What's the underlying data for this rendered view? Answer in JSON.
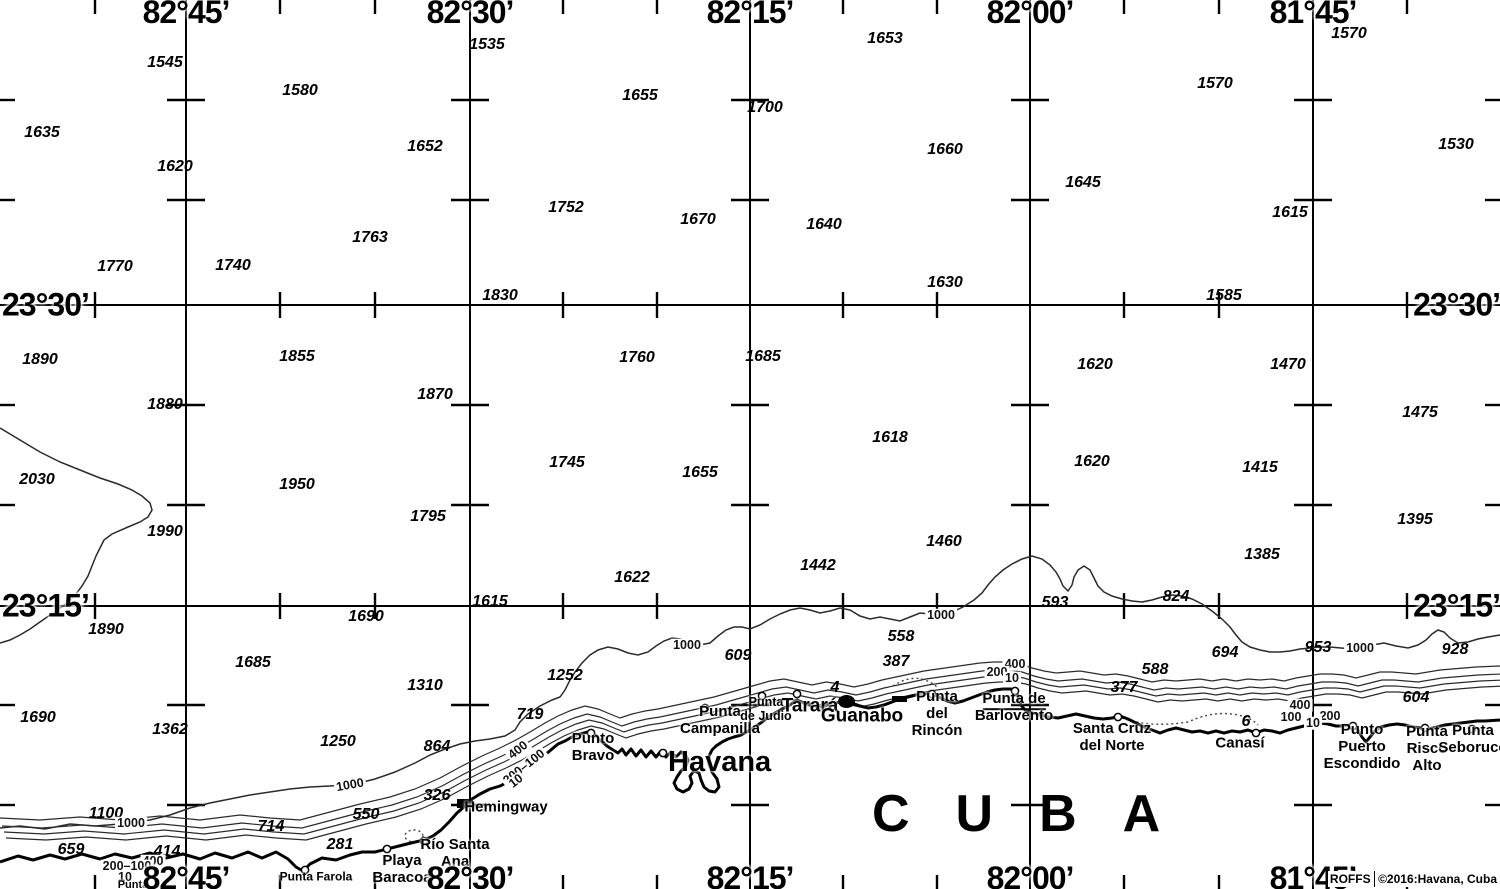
{
  "map": {
    "region_label": "CUBA",
    "city_label": "Havana",
    "credit": {
      "agency": "ROFFS",
      "copyright": "©2016:Havana, Cuba"
    },
    "grid": {
      "lon_lines": [
        {
          "label": "82°45’",
          "x": 186
        },
        {
          "label": "82°30’",
          "x": 470
        },
        {
          "label": "82°15’",
          "x": 750
        },
        {
          "label": "82°00’",
          "x": 1030
        },
        {
          "label": "81°45’",
          "x": 1313
        }
      ],
      "lat_lines": [
        {
          "label": "23°30’",
          "y": 305
        },
        {
          "label": "23°15’",
          "y": 606
        }
      ],
      "minor_tick_x": [
        95,
        280,
        375,
        563,
        657,
        843,
        937,
        1124,
        1219,
        1407
      ],
      "minor_tick_y": [
        100,
        200,
        405,
        505,
        705,
        805
      ]
    },
    "soundings": [
      {
        "v": "1545",
        "x": 165,
        "y": 63
      },
      {
        "v": "1535",
        "x": 487,
        "y": 45
      },
      {
        "v": "1653",
        "x": 885,
        "y": 39
      },
      {
        "v": "1570",
        "x": 1349,
        "y": 34
      },
      {
        "v": "1580",
        "x": 300,
        "y": 91
      },
      {
        "v": "1655",
        "x": 640,
        "y": 96
      },
      {
        "v": "1700",
        "x": 765,
        "y": 108
      },
      {
        "v": "1570",
        "x": 1215,
        "y": 84
      },
      {
        "v": "1635",
        "x": 42,
        "y": 133
      },
      {
        "v": "1652",
        "x": 425,
        "y": 147
      },
      {
        "v": "1660",
        "x": 945,
        "y": 150
      },
      {
        "v": "1530",
        "x": 1456,
        "y": 145
      },
      {
        "v": "1620",
        "x": 175,
        "y": 167
      },
      {
        "v": "1645",
        "x": 1083,
        "y": 183
      },
      {
        "v": "1752",
        "x": 566,
        "y": 208
      },
      {
        "v": "1670",
        "x": 698,
        "y": 220
      },
      {
        "v": "1640",
        "x": 824,
        "y": 225
      },
      {
        "v": "1615",
        "x": 1290,
        "y": 213
      },
      {
        "v": "1763",
        "x": 370,
        "y": 238
      },
      {
        "v": "1770",
        "x": 115,
        "y": 267
      },
      {
        "v": "1740",
        "x": 233,
        "y": 266
      },
      {
        "v": "1630",
        "x": 945,
        "y": 283
      },
      {
        "v": "1830",
        "x": 500,
        "y": 296
      },
      {
        "v": "1585",
        "x": 1224,
        "y": 296
      },
      {
        "v": "1890",
        "x": 40,
        "y": 360
      },
      {
        "v": "1855",
        "x": 297,
        "y": 357
      },
      {
        "v": "1760",
        "x": 637,
        "y": 358
      },
      {
        "v": "1685",
        "x": 763,
        "y": 357
      },
      {
        "v": "1620",
        "x": 1095,
        "y": 365
      },
      {
        "v": "1470",
        "x": 1288,
        "y": 365
      },
      {
        "v": "1880",
        "x": 165,
        "y": 405
      },
      {
        "v": "1870",
        "x": 435,
        "y": 395
      },
      {
        "v": "1475",
        "x": 1420,
        "y": 413
      },
      {
        "v": "1618",
        "x": 890,
        "y": 438
      },
      {
        "v": "2030",
        "x": 37,
        "y": 480
      },
      {
        "v": "1950",
        "x": 297,
        "y": 485
      },
      {
        "v": "1745",
        "x": 567,
        "y": 463
      },
      {
        "v": "1655",
        "x": 700,
        "y": 473
      },
      {
        "v": "1620",
        "x": 1092,
        "y": 462
      },
      {
        "v": "1415",
        "x": 1260,
        "y": 468
      },
      {
        "v": "1990",
        "x": 165,
        "y": 532
      },
      {
        "v": "1795",
        "x": 428,
        "y": 517
      },
      {
        "v": "1460",
        "x": 944,
        "y": 542
      },
      {
        "v": "1395",
        "x": 1415,
        "y": 520
      },
      {
        "v": "1442",
        "x": 818,
        "y": 566
      },
      {
        "v": "1385",
        "x": 1262,
        "y": 555
      },
      {
        "v": "1622",
        "x": 632,
        "y": 578
      },
      {
        "v": "1615",
        "x": 490,
        "y": 602
      },
      {
        "v": "1690",
        "x": 366,
        "y": 617
      },
      {
        "v": "593",
        "x": 1055,
        "y": 603
      },
      {
        "v": "824",
        "x": 1176,
        "y": 597
      },
      {
        "v": "1890",
        "x": 106,
        "y": 630
      },
      {
        "v": "558",
        "x": 901,
        "y": 637
      },
      {
        "v": "694",
        "x": 1225,
        "y": 653
      },
      {
        "v": "953",
        "x": 1318,
        "y": 648
      },
      {
        "v": "928",
        "x": 1455,
        "y": 650
      },
      {
        "v": "1685",
        "x": 253,
        "y": 663
      },
      {
        "v": "609",
        "x": 738,
        "y": 656
      },
      {
        "v": "387",
        "x": 896,
        "y": 662
      },
      {
        "v": "588",
        "x": 1155,
        "y": 670
      },
      {
        "v": "1310",
        "x": 425,
        "y": 686
      },
      {
        "v": "1252",
        "x": 565,
        "y": 676
      },
      {
        "v": "1690",
        "x": 38,
        "y": 718
      },
      {
        "v": "1362",
        "x": 170,
        "y": 730
      },
      {
        "v": "719",
        "x": 530,
        "y": 715
      },
      {
        "v": "377",
        "x": 1124,
        "y": 688
      },
      {
        "v": "604",
        "x": 1416,
        "y": 698
      },
      {
        "v": "1250",
        "x": 338,
        "y": 742
      },
      {
        "v": "864",
        "x": 437,
        "y": 747
      },
      {
        "v": "326",
        "x": 437,
        "y": 796
      },
      {
        "v": "550",
        "x": 366,
        "y": 815
      },
      {
        "v": "1100",
        "x": 106,
        "y": 814
      },
      {
        "v": "714",
        "x": 271,
        "y": 827
      },
      {
        "v": "659",
        "x": 71,
        "y": 850
      },
      {
        "v": "414",
        "x": 167,
        "y": 852
      },
      {
        "v": "281",
        "x": 340,
        "y": 845
      },
      {
        "v": "4",
        "x": 835,
        "y": 688
      },
      {
        "v": "6",
        "x": 1246,
        "y": 722
      }
    ],
    "contour_labels": [
      {
        "v": "1000",
        "x": 131,
        "y": 823,
        "r": 0
      },
      {
        "v": "1000",
        "x": 350,
        "y": 785,
        "r": -10
      },
      {
        "v": "1000",
        "x": 687,
        "y": 645,
        "r": 0
      },
      {
        "v": "1000",
        "x": 941,
        "y": 615,
        "r": 0
      },
      {
        "v": "1000",
        "x": 1360,
        "y": 648,
        "r": 0
      },
      {
        "v": "400",
        "x": 153,
        "y": 861,
        "r": 0
      },
      {
        "v": "400",
        "x": 518,
        "y": 750,
        "r": -38
      },
      {
        "v": "400",
        "x": 1015,
        "y": 664,
        "r": 0
      },
      {
        "v": "400",
        "x": 1300,
        "y": 705,
        "r": 0
      },
      {
        "v": "200–100",
        "x": 127,
        "y": 866,
        "r": 0
      },
      {
        "v": "200–100",
        "x": 524,
        "y": 767,
        "r": -38
      },
      {
        "v": "200",
        "x": 997,
        "y": 672,
        "r": 0
      },
      {
        "v": "200",
        "x": 1330,
        "y": 716,
        "r": 0
      },
      {
        "v": "100",
        "x": 1291,
        "y": 717,
        "r": 0
      },
      {
        "v": "10",
        "x": 125,
        "y": 877,
        "r": 0
      },
      {
        "v": "10",
        "x": 516,
        "y": 781,
        "r": -38
      },
      {
        "v": "10",
        "x": 1012,
        "y": 678,
        "r": 0
      },
      {
        "v": "10",
        "x": 1313,
        "y": 723,
        "r": 0
      }
    ],
    "places": [
      {
        "lines": [
          "Punta Farola"
        ],
        "x": 316,
        "y": 877,
        "size": 12,
        "marker": [
          305,
          870
        ]
      },
      {
        "lines": [
          "Playa",
          "Baracoa"
        ],
        "x": 402,
        "y": 870,
        "size": 15,
        "marker": [
          387,
          849
        ]
      },
      {
        "lines": [
          "Río Santa",
          "Ana"
        ],
        "x": 455,
        "y": 854,
        "size": 15,
        "marker": [
          424,
          841
        ]
      },
      {
        "lines": [
          "Hemingway"
        ],
        "x": 506,
        "y": 808,
        "size": 15
      },
      {
        "lines": [
          "Punto",
          "Bravo"
        ],
        "x": 593,
        "y": 748,
        "size": 15,
        "marker": [
          591,
          733
        ]
      },
      {
        "lines": [
          "Punta",
          "Campanilla"
        ],
        "x": 720,
        "y": 721,
        "size": 15,
        "marker": [
          705,
          708
        ]
      },
      {
        "lines": [
          "Punta",
          "de Judio"
        ],
        "x": 766,
        "y": 709,
        "size": 12.5,
        "marker": [
          762,
          696
        ]
      },
      {
        "lines": [
          "Tarará"
        ],
        "x": 810,
        "y": 706,
        "size": 19,
        "marker": [
          797,
          694
        ]
      },
      {
        "lines": [
          "Guanabo"
        ],
        "x": 862,
        "y": 716,
        "size": 19
      },
      {
        "lines": [
          "Punta",
          "del",
          "Rincón"
        ],
        "x": 937,
        "y": 714,
        "size": 15,
        "marker": [
          932,
          694
        ]
      },
      {
        "lines": [
          "Punta de",
          "Barlovento"
        ],
        "x": 1014,
        "y": 708,
        "size": 15,
        "u": 0,
        "marker": [
          1015,
          691
        ]
      },
      {
        "lines": [
          "Santa Cruz",
          "del Norte"
        ],
        "x": 1112,
        "y": 738,
        "size": 15,
        "marker": [
          1118,
          717
        ]
      },
      {
        "lines": [
          "Canasí"
        ],
        "x": 1240,
        "y": 744,
        "size": 15,
        "marker": [
          1256,
          733
        ]
      },
      {
        "lines": [
          "Punto",
          "Puerto",
          "Escondido"
        ],
        "x": 1362,
        "y": 747,
        "size": 15,
        "marker": [
          1353,
          726
        ]
      },
      {
        "lines": [
          "Punta",
          "Risco",
          "Alto"
        ],
        "x": 1427,
        "y": 749,
        "size": 15,
        "marker": [
          1425,
          728
        ]
      },
      {
        "lines": [
          "Punta",
          "Seboruco"
        ],
        "x": 1473,
        "y": 740,
        "size": 15,
        "marker": [
          1472,
          729
        ]
      },
      {
        "lines": [
          "Punta"
        ],
        "x": 133,
        "y": 885,
        "size": 11
      }
    ],
    "special_markers": [
      {
        "t": "square",
        "x": 457,
        "y": 799,
        "w": 16,
        "h": 9,
        "name": "hemingway-marina-marker"
      },
      {
        "t": "blob",
        "x": 838,
        "y": 695,
        "w": 17,
        "h": 13,
        "name": "guanabo-townfill-marker"
      },
      {
        "t": "bar",
        "x": 892,
        "y": 696,
        "w": 15,
        "h": 6,
        "name": "settlement-fill-marker"
      },
      {
        "t": "circle",
        "x": 663,
        "y": 753,
        "name": "havana-marker"
      }
    ]
  },
  "colors": {
    "ink": "#000000",
    "contour": "#2b2b2b",
    "background": "#ffffff"
  }
}
